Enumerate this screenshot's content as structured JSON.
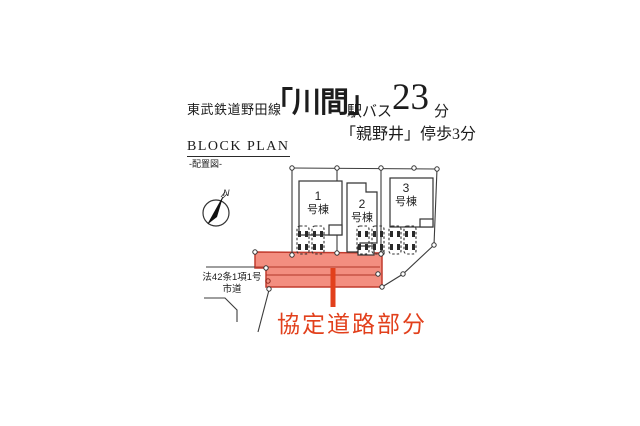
{
  "header": {
    "railway_line": "東武鉄道野田線",
    "station": "「川間」",
    "access_mode": "駅バス",
    "minutes": "23",
    "minutes_unit": "分",
    "bus_stop_access": "「親野井」停歩3分"
  },
  "plan": {
    "title": "BLOCK PLAN",
    "subtitle": "-配置図-",
    "compass_north_label": "N",
    "public_road_label": [
      "法42条1項1号",
      "市道"
    ],
    "agreement_road_label": "協定道路部分",
    "buildings": [
      {
        "number": "1",
        "suffix": "号棟"
      },
      {
        "number": "2",
        "suffix": "号棟"
      },
      {
        "number": "3",
        "suffix": "号棟"
      }
    ],
    "colors": {
      "agreement_road_fill": "#F28272",
      "agreement_road_border": "#C23B2E",
      "agreement_label": "#E2401C",
      "plan_line": "#3c3c3c"
    }
  }
}
